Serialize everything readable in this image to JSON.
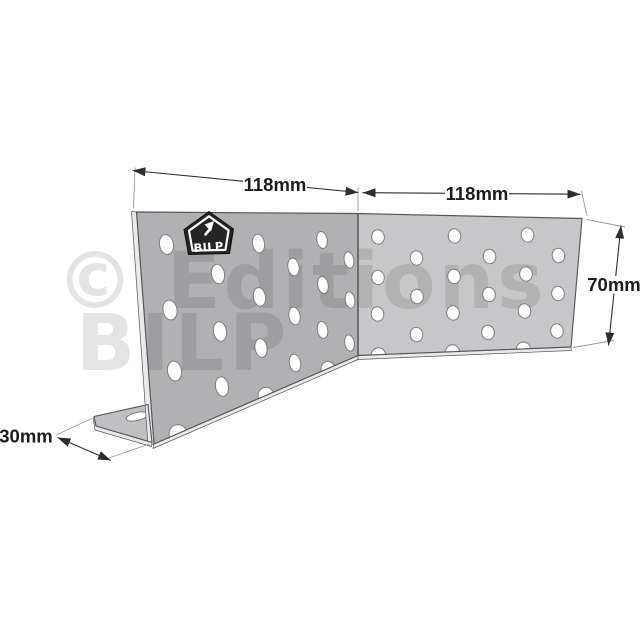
{
  "watermark": {
    "line1": "© Editions",
    "line2": "BILP"
  },
  "logo": {
    "label": "BILP"
  },
  "dimensions": {
    "plate_left_length": "118mm",
    "plate_right_length": "118mm",
    "height": "70mm",
    "foot_depth": "30mm"
  },
  "colors": {
    "background": "#ffffff",
    "plate_left": "#b1b1b3",
    "plate_right": "#c7c7c9",
    "flange_top": "#c0c0c2",
    "plate_edge_light": "#eaeaea",
    "outline": "#55555a",
    "hole_fill": "#fdfdfd",
    "hole_rim": "#7e7e82",
    "dimension_line": "#2e2e2e",
    "dimension_text": "#1c1c1c",
    "extension_line": "#9a9a9a",
    "watermark_color": "rgba(0,0,0,0.105)",
    "badge_fill": "#242424",
    "badge_border": "#f5f5f5"
  }
}
